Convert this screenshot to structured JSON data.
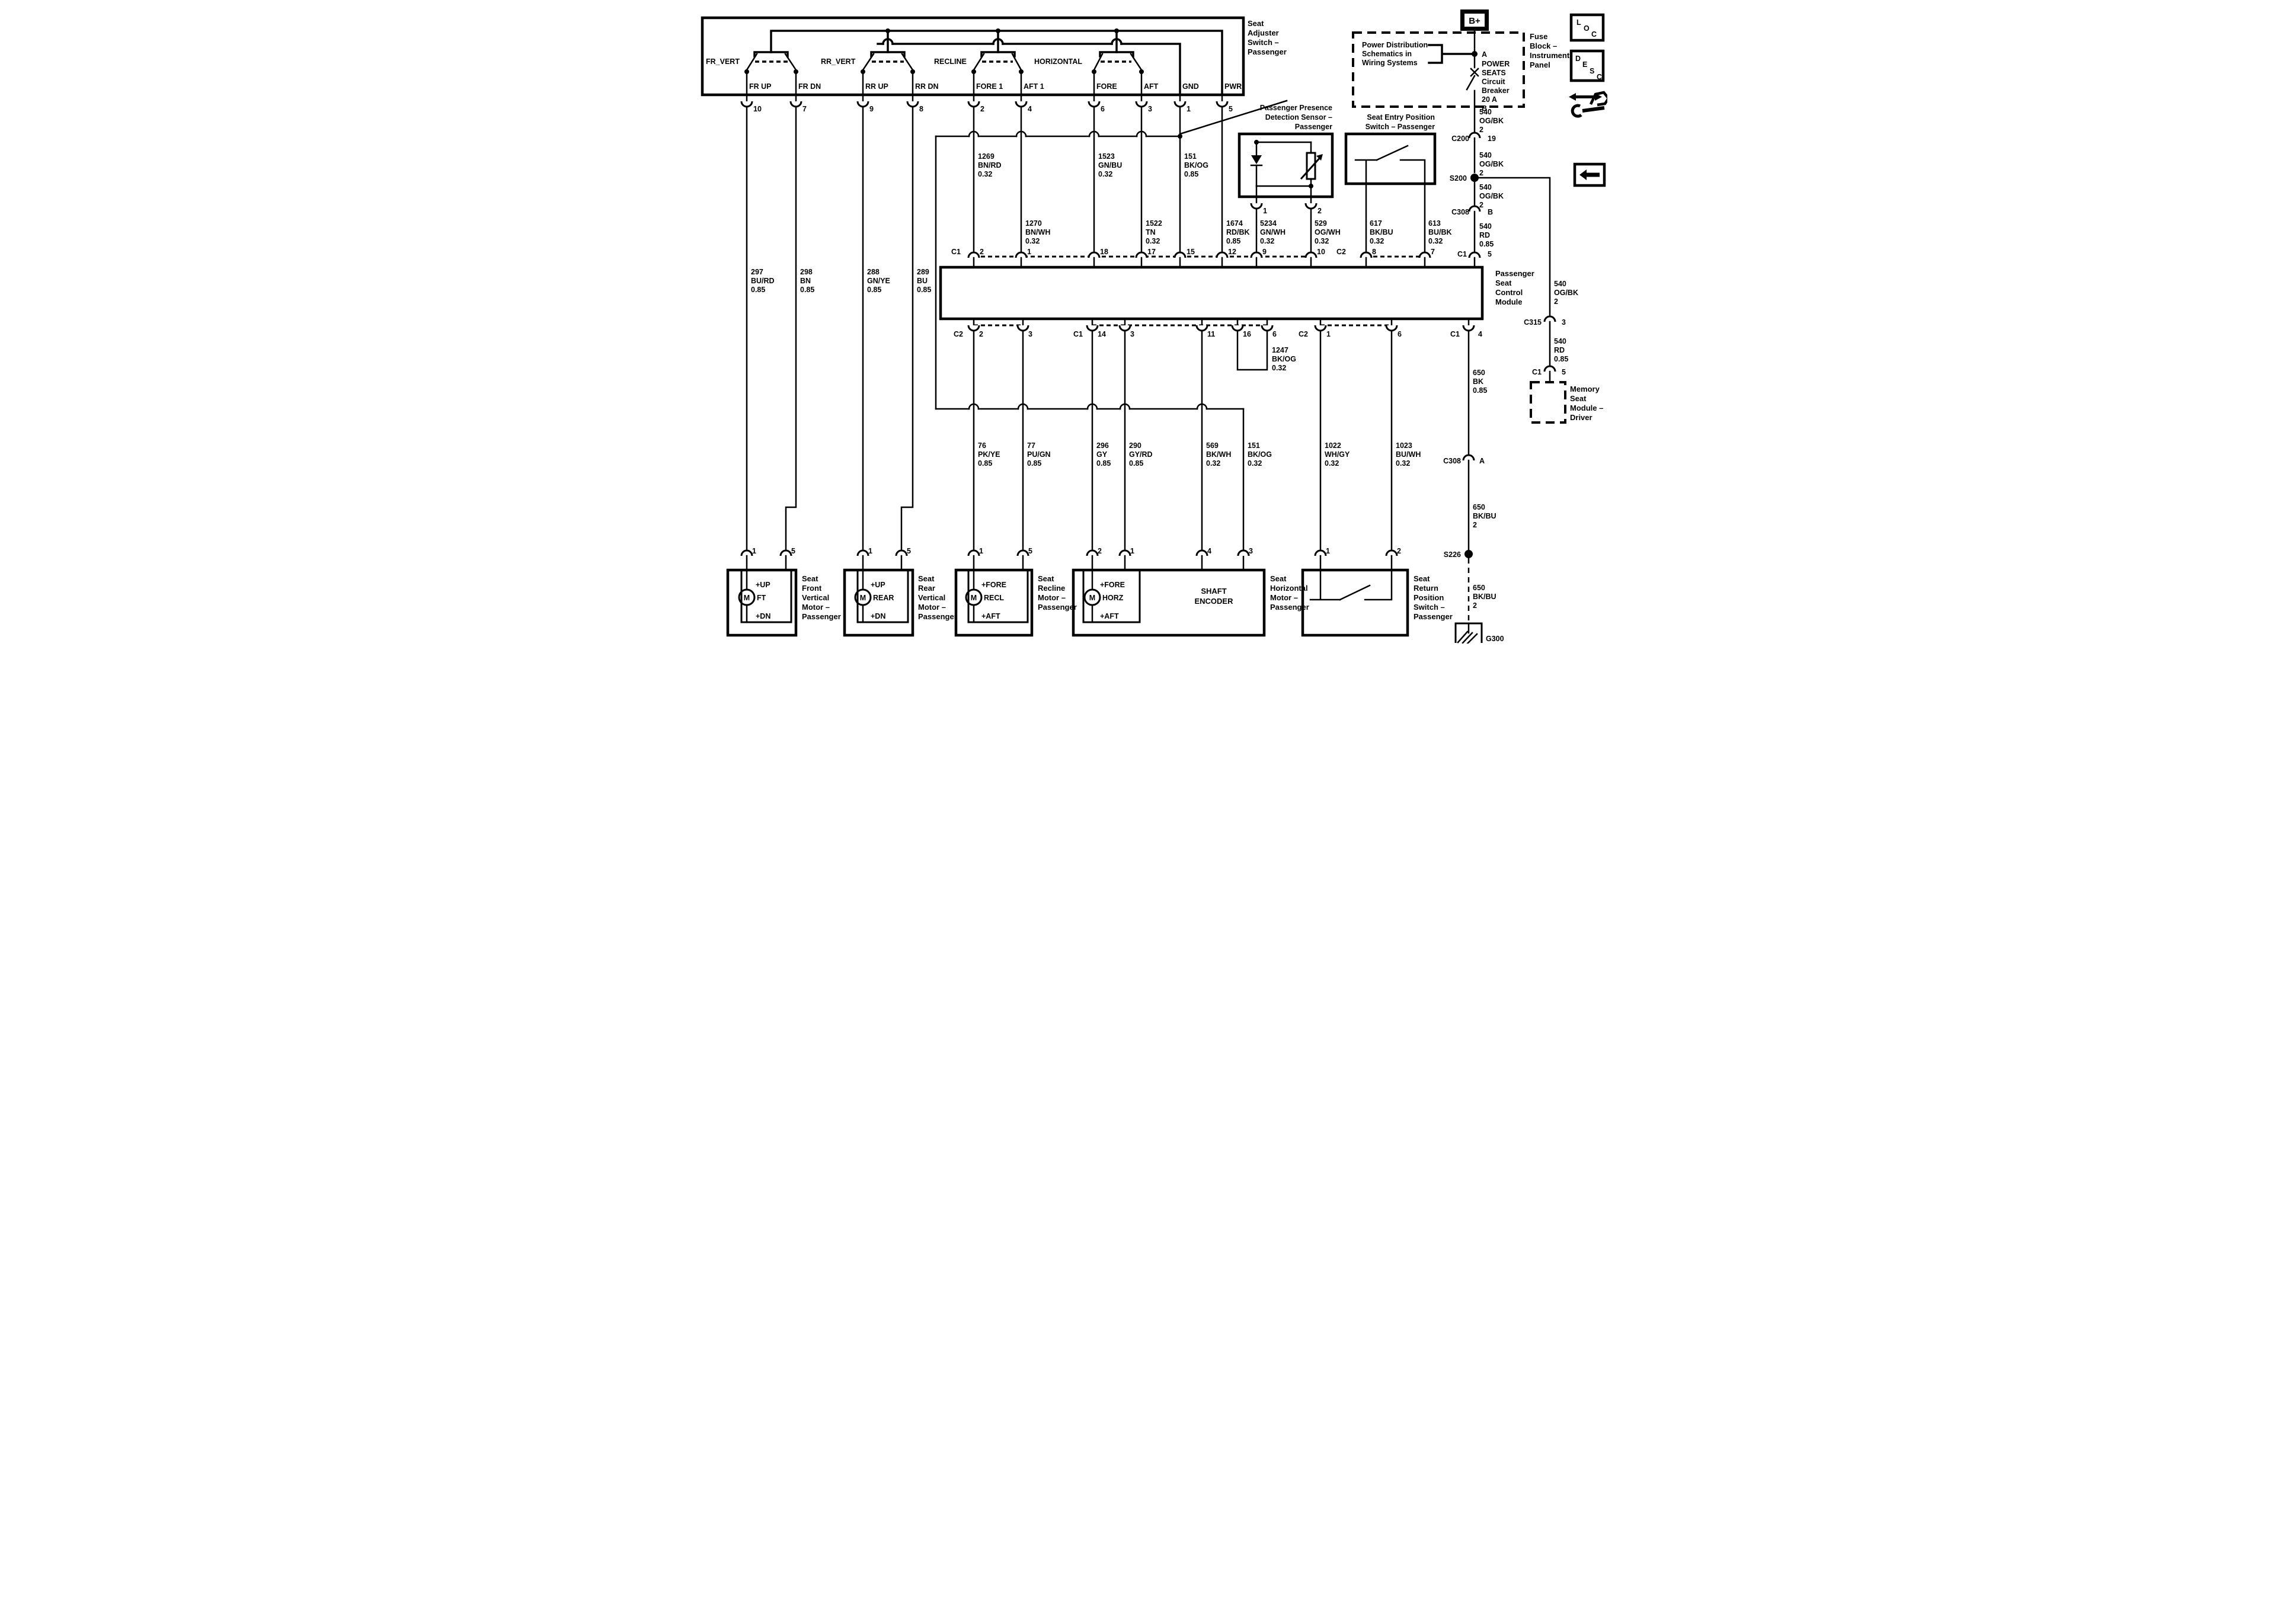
{
  "switch_assembly": {
    "title": [
      "Seat",
      "Adjuster",
      "Switch –",
      "Passenger"
    ],
    "switch_names": [
      "FR_VERT",
      "RR_VERT",
      "RECLINE",
      "HORIZONTAL"
    ],
    "terminals": [
      "FR UP",
      "FR DN",
      "RR UP",
      "RR DN",
      "FORE 1",
      "AFT 1",
      "FORE",
      "AFT",
      "GND",
      "PWR"
    ],
    "pins": [
      "10",
      "7",
      "9",
      "8",
      "2",
      "4",
      "6",
      "3",
      "1",
      "5"
    ]
  },
  "power": {
    "b_plus": "B+",
    "fuse_block": [
      "Fuse",
      "Block –",
      "Instrument",
      "Panel"
    ],
    "power_distribution": [
      "Power Distribution",
      "Schematics in",
      "Wiring  Systems"
    ],
    "breaker": [
      "A",
      "POWER",
      "SEATS",
      "Circuit",
      "Breaker",
      "20 A",
      "B"
    ]
  },
  "icons": {
    "loc": [
      "L",
      "O",
      "C"
    ],
    "desc": [
      "D",
      "E",
      "S",
      "C"
    ]
  },
  "sensor": {
    "title": [
      "Passenger Presence",
      "Detection Sensor –",
      "Passenger"
    ],
    "pins": [
      "1",
      "2"
    ]
  },
  "entry_switch": {
    "title": [
      "Seat Entry Position",
      "Switch – Passenger"
    ]
  },
  "module": {
    "title": [
      "Passenger",
      "Seat",
      "Control",
      "Module"
    ],
    "top": {
      "c1": "C1",
      "c1_pins": [
        "2",
        "1",
        "18",
        "17",
        "15",
        "12",
        "9",
        "10"
      ],
      "c2": "C2",
      "c2_pins": [
        "8",
        "7"
      ],
      "c1r": "C1",
      "c1r_pin": "5"
    },
    "bottom": {
      "c2": "C2",
      "c2_pins": [
        "2",
        "3"
      ],
      "c1": "C1",
      "c1_pins": [
        "14",
        "3",
        "11",
        "16",
        "6"
      ],
      "c2b": "C2",
      "c2b_pins": [
        "1",
        "6"
      ],
      "c1b": "C1",
      "c1b_pin": "4"
    }
  },
  "memory_module": {
    "title": [
      "Memory",
      "Seat",
      "Module –",
      "Driver"
    ]
  },
  "wires": {
    "w297": [
      "297",
      "BU/RD",
      "0.85"
    ],
    "w298": [
      "298",
      "BN",
      "0.85"
    ],
    "w288": [
      "288",
      "GN/YE",
      "0.85"
    ],
    "w289": [
      "289",
      "BU",
      "0.85"
    ],
    "w1269": [
      "1269",
      "BN/RD",
      "0.32"
    ],
    "w1523": [
      "1523",
      "GN/BU",
      "0.32"
    ],
    "w151a": [
      "151",
      "BK/OG",
      "0.85"
    ],
    "w1270": [
      "1270",
      "BN/WH",
      "0.32"
    ],
    "w1522": [
      "1522",
      "TN",
      "0.32"
    ],
    "w1674": [
      "1674",
      "RD/BK",
      "0.85"
    ],
    "w5234": [
      "5234",
      "GN/WH",
      "0.32"
    ],
    "w529": [
      "529",
      "OG/WH",
      "0.32"
    ],
    "w617": [
      "617",
      "BK/BU",
      "0.32"
    ],
    "w613": [
      "613",
      "BU/BK",
      "0.32"
    ],
    "w1247": [
      "1247",
      "BK/OG",
      "0.32"
    ],
    "w76": [
      "76",
      "PK/YE",
      "0.85"
    ],
    "w77": [
      "77",
      "PU/GN",
      "0.85"
    ],
    "w296": [
      "296",
      "GY",
      "0.85"
    ],
    "w290": [
      "290",
      "GY/RD",
      "0.85"
    ],
    "w569": [
      "569",
      "BK/WH",
      "0.32"
    ],
    "w151b": [
      "151",
      "BK/OG",
      "0.32"
    ],
    "w1022": [
      "1022",
      "WH/GY",
      "0.32"
    ],
    "w1023": [
      "1023",
      "BU/WH",
      "0.32"
    ],
    "w540": [
      "540",
      "OG/BK",
      "2"
    ],
    "w540rd": [
      "540",
      "RD",
      "0.85"
    ],
    "w650": [
      "650",
      "BK",
      "0.85"
    ],
    "w650bu": [
      "650",
      "BK/BU",
      "2"
    ]
  },
  "connectors": {
    "c200": [
      "C200",
      "19"
    ],
    "s200": "S200",
    "c308b": [
      "C308",
      "B"
    ],
    "c15": [
      "C1",
      "5"
    ],
    "c315": [
      "C315",
      "3"
    ],
    "c308a": [
      "C308",
      "A"
    ],
    "s226": "S226",
    "g300": "G300"
  },
  "motors": {
    "front": {
      "label": [
        "Seat",
        "Front",
        "Vertical",
        "Motor –",
        "Passenger"
      ],
      "pins": [
        "1",
        "5"
      ],
      "m": "M",
      "tag": "FT",
      "up": "+UP",
      "dn": "+DN"
    },
    "rear": {
      "label": [
        "Seat",
        "Rear",
        "Vertical",
        "Motor –",
        "Passenger"
      ],
      "pins": [
        "1",
        "5"
      ],
      "m": "M",
      "tag": "REAR",
      "up": "+UP",
      "dn": "+DN"
    },
    "recline": {
      "label": [
        "Seat",
        "Recline",
        "Motor –",
        "Passenger"
      ],
      "pins": [
        "1",
        "5"
      ],
      "m": "M",
      "tag": "RECL",
      "fore": "+FORE",
      "aft": "+AFT"
    },
    "horizontal": {
      "label": [
        "Seat",
        "Horizontal",
        "Motor –",
        "Passenger"
      ],
      "pins": [
        "2",
        "1",
        "4",
        "3"
      ],
      "m": "M",
      "tag": "HORZ",
      "fore": "+FORE",
      "aft": "+AFT",
      "encoder": [
        "SHAFT",
        "ENCODER"
      ]
    },
    "return_switch": {
      "label": [
        "Seat",
        "Return",
        "Position",
        "Switch –",
        "Passenger"
      ],
      "pins": [
        "1",
        "2"
      ]
    }
  }
}
